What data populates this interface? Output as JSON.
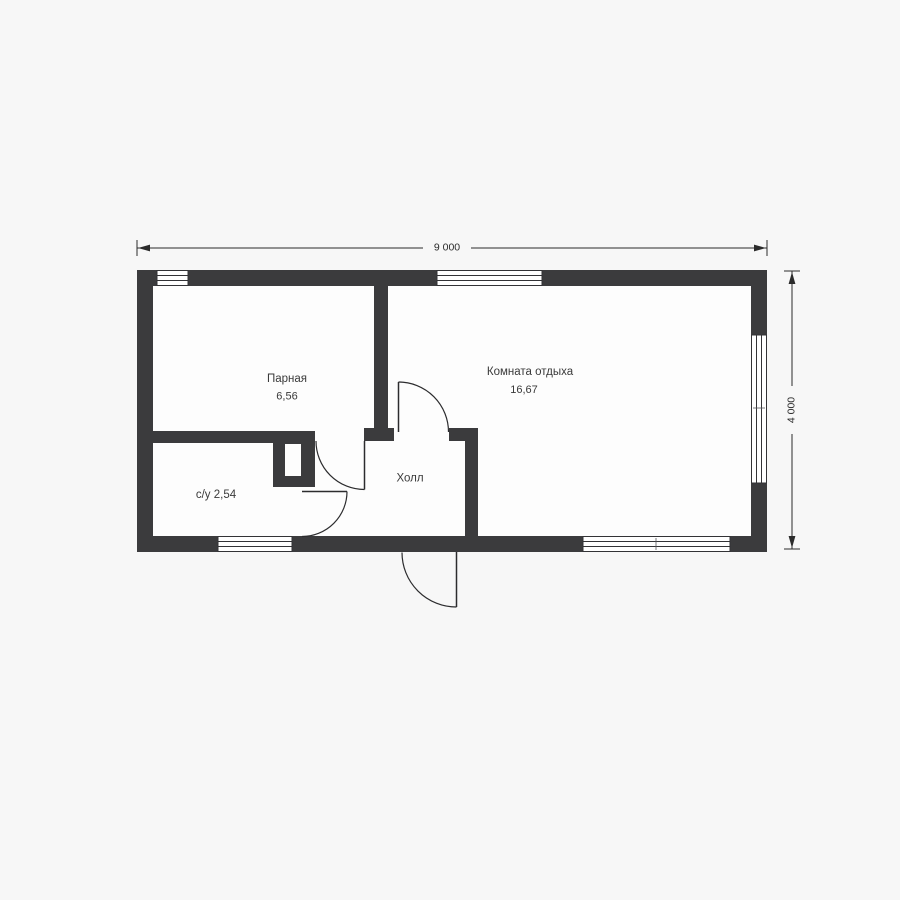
{
  "plan_type": "floor-plan",
  "rooms": {
    "steam_room": {
      "label": "Парная",
      "area": "6,56"
    },
    "rest_room": {
      "label": "Комната отдыха",
      "area": "16,67"
    },
    "bathroom": {
      "label": "с/у 2,54"
    },
    "hall": {
      "label": "Холл"
    }
  },
  "dimensions": {
    "width_label": "9 000",
    "height_label": "4 000"
  },
  "colors": {
    "wall": "#3b3b3d",
    "line": "#2b2b2b",
    "background": "#f7f7f7",
    "room_fill": "#fdfdfd",
    "text": "#3a3a3a"
  }
}
